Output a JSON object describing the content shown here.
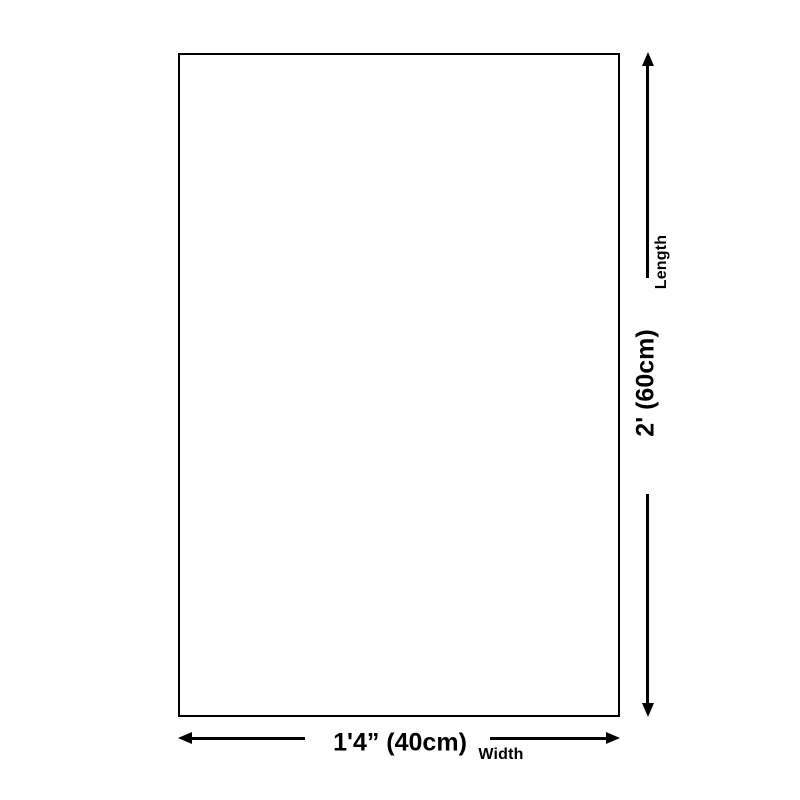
{
  "page": {
    "background_color": "#ffffff",
    "line_color": "#000000"
  },
  "diagram": {
    "type": "product-dimension-diagram",
    "shape": "rectangle",
    "vertical_dimension": {
      "axis_label": "Length",
      "value": "2' (60cm)",
      "arrow_icons": [
        "arrow-up-icon",
        "arrow-down-icon"
      ]
    },
    "horizontal_dimension": {
      "axis_label": "Width",
      "value": "1'4” (40cm)",
      "arrow_icons": [
        "arrow-left-icon",
        "arrow-right-icon"
      ]
    }
  }
}
